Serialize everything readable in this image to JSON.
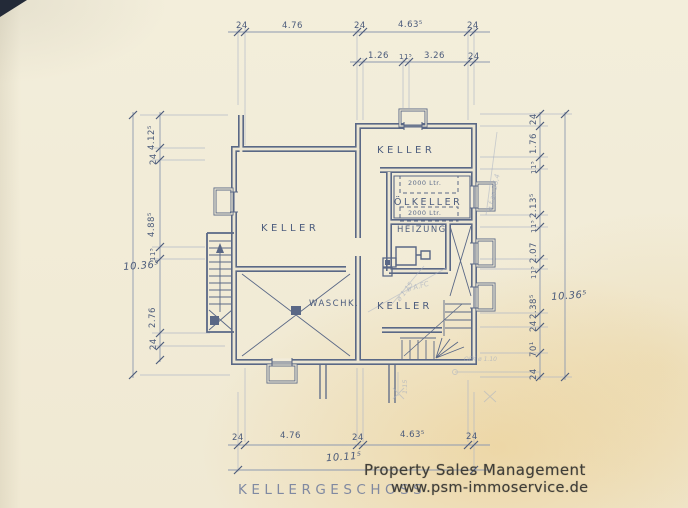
{
  "plan": {
    "title": "KELLERGESCHOSS",
    "rooms": {
      "keller_top": "KELLER",
      "oelkeller": "ÖLKELLER",
      "heizung": "HEIZUNG",
      "keller_left": "KELLER",
      "waschk": "WASCHK.",
      "keller_bottom": "KELLER"
    },
    "tanks": {
      "tank1": "2000 Ltr.",
      "tank2": "2000 Ltr."
    },
    "dims": {
      "top_row1": [
        "24",
        "4.76",
        "24",
        "4.63⁵",
        "24"
      ],
      "top_row2": [
        "1.26",
        "11⁵",
        "3.26",
        "24"
      ],
      "bottom_row": [
        "24",
        "4.76",
        "24",
        "4.63⁵",
        "24"
      ],
      "bottom_total": "10.11⁵",
      "left_outer": "10.36⁵",
      "left_chain": [
        "4.12⁵",
        "24",
        "4.88⁵",
        "11⁵",
        "2.76",
        "24"
      ],
      "right_chain": [
        "24",
        "1.76",
        "11⁵",
        "2.13⁵",
        "11⁵",
        "2.07",
        "11⁵",
        "2.38⁵",
        "24",
        "70¹",
        "24"
      ],
      "right_outer": "10.36⁵"
    },
    "pencil": {
      "n1": "ø f.an 26,4",
      "n2": "ø 1.15",
      "n3": "ø A.FC",
      "n4": "OFK ø 1.10",
      "n5": "1.15"
    }
  },
  "watermark": {
    "line1": "Property Sales Management",
    "line2": "www.psm-immoservice.de"
  },
  "colors": {
    "paper": "#f2ecda",
    "ink": "#5a6886",
    "ink_light": "#8d99b0",
    "pencil": "#a8b1c3",
    "watermark_text": "#403e38"
  }
}
